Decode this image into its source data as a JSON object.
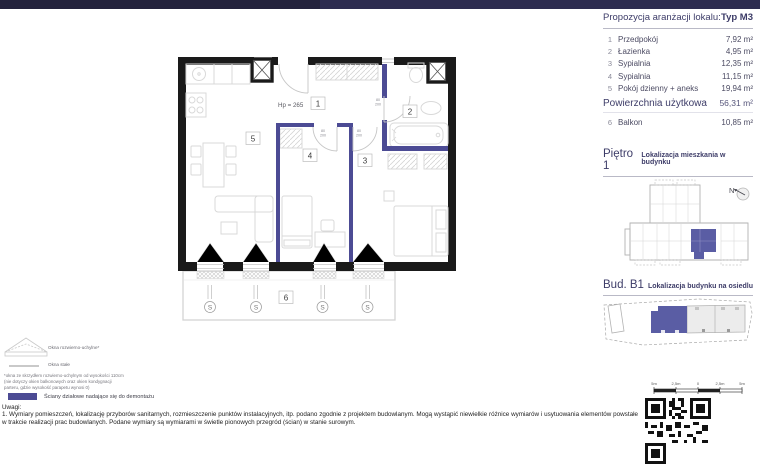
{
  "table": {
    "title": "Propozycja aranżacji lokalu:",
    "type": "Typ M3",
    "rows": [
      {
        "no": "1",
        "name": "Przedpokój",
        "area": "7,92 m²"
      },
      {
        "no": "2",
        "name": "Łazienka",
        "area": "4,95 m²"
      },
      {
        "no": "3",
        "name": "Sypialnia",
        "area": "12,35 m²"
      },
      {
        "no": "4",
        "name": "Sypialnia",
        "area": "11,15 m²"
      },
      {
        "no": "5",
        "name": "Pokój dzienny + aneks",
        "area": "19,94 m²"
      }
    ],
    "total_label": "Powierzchnia użytkowa",
    "total_area": "56,31 m²",
    "balcony_row": {
      "no": "6",
      "name": "Balkon",
      "area": "10,85 m²"
    }
  },
  "plan": {
    "hp_label": "Hp = 265",
    "rooms": [
      "1",
      "2",
      "3",
      "4",
      "5",
      "6"
    ],
    "door_width": "80",
    "door_height": "200",
    "window_symbol": "S"
  },
  "floor_section": {
    "title": "Piętro 1",
    "subtitle": "Lokalizacja mieszkania w budynku",
    "compass_n": "N"
  },
  "building_section": {
    "title": "Bud. B1",
    "subtitle": "Lokalizacja budynku na osiedlu"
  },
  "scale_bar": {
    "labels": [
      "5m",
      "2,5m",
      "0",
      "2,5m",
      "5m"
    ]
  },
  "legend": {
    "tilt_windows": "Okna rozwierno-uchylne*",
    "fixed_windows": "Okna stałe",
    "footnote": "*okna ze skrzydłem rozwierno-uchylnym od wysokości 110cm (nie dotyczy okien balkonowych oraz okien kondygnacji parteru, gdzie wysokość parapetu wynosi 0)",
    "demolition_walls": "Ściany działowe nadające się do demontażu"
  },
  "notes": {
    "heading": "Uwagi:",
    "body": "1. Wymiary pomieszczeń, lokalizację  przyborów  sanitarnych, rozmieszczenie punktów instalacyjnych, itp. podano zgodnie z projektem budowlanym. Mogą wystąpić niewielkie różnice wymiarów i usytuowania elementów powstałe w trakcie realizacji prac budowlanych. Podane wymiary są wymiarami w świetle pionowych przegród (ścian) w stanie surowym."
  },
  "colors": {
    "accent_navy": "#3d3c68",
    "partition_wall": "#4c4b94",
    "unit_highlight": "#5a5da4",
    "wall_black": "#1a1a1a",
    "topbar_left": "#23223c",
    "topbar_right": "#2d2c50"
  }
}
